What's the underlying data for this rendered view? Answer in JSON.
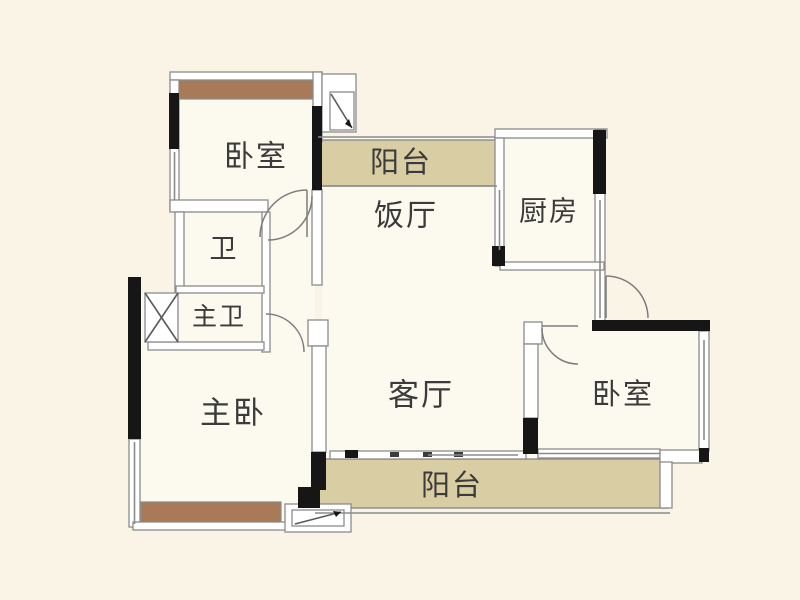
{
  "plan": {
    "title": "apartment-floor-plan",
    "rooms": {
      "bedroom_top": {
        "label": "卧室"
      },
      "balcony_top": {
        "label": "阳台"
      },
      "dining": {
        "label": "饭厅"
      },
      "kitchen": {
        "label": "厨房"
      },
      "bath": {
        "label": "卫"
      },
      "master_bath": {
        "label": "主卫"
      },
      "master_bedroom": {
        "label": "主卧"
      },
      "living": {
        "label": "客厅"
      },
      "bedroom_right": {
        "label": "卧室"
      },
      "balcony_bottom": {
        "label": "阳台"
      }
    },
    "colors": {
      "background": "#f9f4e6",
      "room_interior": "#fcf9ef",
      "wall_line": "#8b8b8b",
      "wall_black": "#161616",
      "bay_window_brown": "#a87a58",
      "balcony_tan": "#d9cda3",
      "label_text": "#3b3b3b"
    }
  }
}
